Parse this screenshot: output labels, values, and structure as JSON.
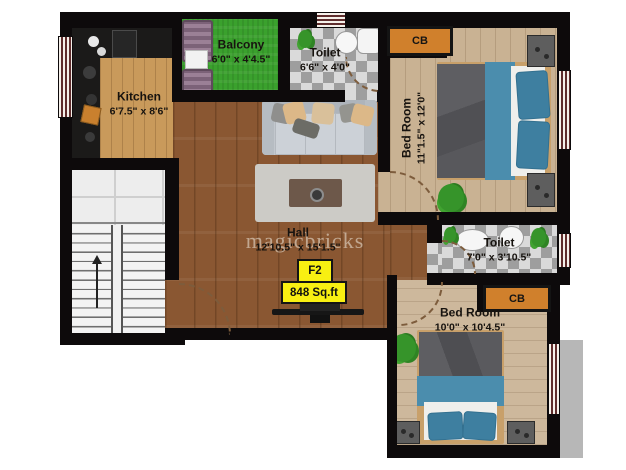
{
  "watermark": "magicbricks",
  "unit": {
    "flat": "F2",
    "area": "848 Sq.ft"
  },
  "rooms": {
    "kitchen": {
      "name": "Kitchen",
      "dims": "6'7.5\" x 8'6\""
    },
    "balcony": {
      "name": "Balcony",
      "dims": "6'0\" x 4'4.5\""
    },
    "toilet_top": {
      "name": "Toilet",
      "dims": "6'6\" x 4'0\""
    },
    "bedroom_right": {
      "name": "Bed Room",
      "dims": "11\"1.5\" x 12'0\""
    },
    "hall": {
      "name": "Hall",
      "dims": "12'10.5\" x 15'1.5\""
    },
    "toilet_right": {
      "name": "Toilet",
      "dims": "7'0\" x 3'10.5\""
    },
    "bedroom_bottom": {
      "name": "Bed Room",
      "dims": "10'0\" x 10'4.5\""
    },
    "cupboard_top": {
      "label": "CB"
    },
    "cupboard_bottom": {
      "label": "CB"
    }
  },
  "colors": {
    "wall": "#0d0a0b",
    "cupboard": "#d0802c",
    "grass": "#3aa12d",
    "unit_label_bg": "#f8ef12",
    "hall_wood": "#8a5732",
    "bedroom_wood": "#c9b293",
    "bed_blue": "#4b8dad",
    "window_frame": "#5e2c2c"
  }
}
